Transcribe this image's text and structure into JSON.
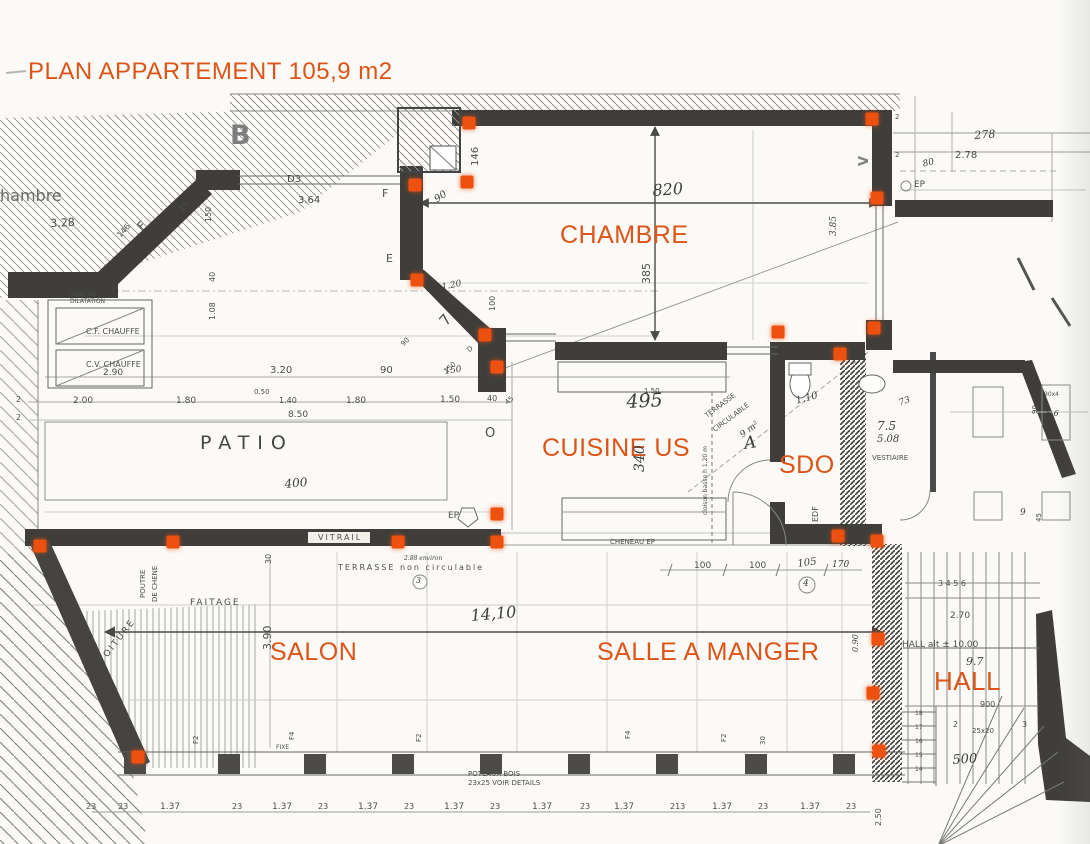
{
  "title": {
    "text": "PLAN APPARTEMENT 105,9 m2"
  },
  "colors": {
    "accent": "#dd5418",
    "marker": "#ee5010",
    "pencil": "#4d4d4d",
    "wall": "#3f3e3b"
  },
  "rooms": [
    {
      "id": "chambre",
      "label": "CHAMBRE",
      "x": 560,
      "y": 221,
      "s": 25
    },
    {
      "id": "cuisine-us",
      "label": "CUISINE US",
      "x": 542,
      "y": 434,
      "s": 25
    },
    {
      "id": "sdo",
      "label": "SDO",
      "x": 779,
      "y": 451,
      "s": 25
    },
    {
      "id": "salon",
      "label": "SALON",
      "x": 270,
      "y": 638,
      "s": 25
    },
    {
      "id": "salle-a-manger",
      "label": "SALLE A MANGER",
      "x": 597,
      "y": 638,
      "s": 25
    },
    {
      "id": "hall",
      "label": "HALL",
      "x": 934,
      "y": 666,
      "s": 26
    }
  ],
  "annotations": [
    {
      "t": "hambre",
      "x": 0,
      "y": 188,
      "s": 16,
      "c": "lt"
    },
    {
      "t": "3.28",
      "x": 50,
      "y": 218,
      "s": 11,
      "r": -3
    },
    {
      "t": "B",
      "x": 230,
      "y": 122,
      "s": 27,
      "c": "bletter"
    },
    {
      "t": "D3",
      "x": 287,
      "y": 175,
      "s": 10
    },
    {
      "t": "3.64",
      "x": 298,
      "y": 196,
      "s": 10
    },
    {
      "t": "F",
      "x": 135,
      "y": 224,
      "s": 12,
      "r": -45
    },
    {
      "t": "25",
      "x": 178,
      "y": 208,
      "s": 8,
      "r": -48
    },
    {
      "t": "146",
      "x": 116,
      "y": 234,
      "s": 8,
      "r": -48
    },
    {
      "t": "150",
      "x": 205,
      "y": 222,
      "s": 8,
      "r": -90
    },
    {
      "t": "F",
      "x": 382,
      "y": 188,
      "s": 11
    },
    {
      "t": "E",
      "x": 386,
      "y": 253,
      "s": 11
    },
    {
      "t": "JOINT DE",
      "x": 70,
      "y": 292,
      "s": 6
    },
    {
      "t": "DILATATION",
      "x": 70,
      "y": 299,
      "s": 6
    },
    {
      "t": "C.F. CHAUFFE",
      "x": 86,
      "y": 328,
      "s": 8
    },
    {
      "t": "C.V. CHAUFFE",
      "x": 86,
      "y": 361,
      "s": 8
    },
    {
      "t": "2.90",
      "x": 103,
      "y": 369,
      "s": 9
    },
    {
      "t": "40",
      "x": 209,
      "y": 282,
      "s": 8,
      "r": -90
    },
    {
      "t": "1.08",
      "x": 209,
      "y": 320,
      "s": 8,
      "r": -90
    },
    {
      "t": "2",
      "x": 16,
      "y": 396,
      "s": 8
    },
    {
      "t": "2",
      "x": 16,
      "y": 414,
      "s": 8
    },
    {
      "t": "3.20",
      "x": 270,
      "y": 366,
      "s": 10
    },
    {
      "t": "90",
      "x": 380,
      "y": 366,
      "s": 10
    },
    {
      "t": "150",
      "x": 444,
      "y": 368,
      "s": 9,
      "r": -8,
      "c": "hand"
    },
    {
      "t": "2.00",
      "x": 73,
      "y": 397,
      "s": 9
    },
    {
      "t": "1.80",
      "x": 176,
      "y": 397,
      "s": 9
    },
    {
      "t": "0.50",
      "x": 254,
      "y": 389,
      "s": 7
    },
    {
      "t": "1.40",
      "x": 279,
      "y": 397,
      "s": 8
    },
    {
      "t": "1.80",
      "x": 346,
      "y": 397,
      "s": 9
    },
    {
      "t": "1.50",
      "x": 440,
      "y": 396,
      "s": 9
    },
    {
      "t": "40",
      "x": 487,
      "y": 395,
      "s": 8
    },
    {
      "t": "45",
      "x": 504,
      "y": 401,
      "s": 7,
      "r": -40
    },
    {
      "t": "8.50",
      "x": 288,
      "y": 411,
      "s": 9
    },
    {
      "t": "PATIO",
      "x": 200,
      "y": 434,
      "s": 19,
      "c": "patio"
    },
    {
      "t": "400",
      "x": 284,
      "y": 478,
      "s": 12,
      "r": -5,
      "c": "hand"
    },
    {
      "t": "VITRAIL",
      "x": 318,
      "y": 534,
      "s": 8,
      "c": "ls2"
    },
    {
      "t": "EP",
      "x": 448,
      "y": 512,
      "s": 9
    },
    {
      "t": "O",
      "x": 485,
      "y": 427,
      "s": 13
    },
    {
      "t": "TERRASSE  non circulable",
      "x": 338,
      "y": 564,
      "s": 8,
      "c": "ls2"
    },
    {
      "t": "2.88 environ",
      "x": 404,
      "y": 556,
      "s": 6,
      "c": "hand"
    },
    {
      "t": "3",
      "x": 416,
      "y": 577,
      "s": 8,
      "c": "hand"
    },
    {
      "t": "820",
      "x": 652,
      "y": 183,
      "s": 16,
      "r": -4,
      "c": "hand"
    },
    {
      "t": "385",
      "x": 641,
      "y": 284,
      "s": 11,
      "r": -90
    },
    {
      "t": "3.85",
      "x": 830,
      "y": 236,
      "s": 9,
      "r": -90,
      "c": "hand"
    },
    {
      "t": "146",
      "x": 471,
      "y": 166,
      "s": 10,
      "r": -90
    },
    {
      "t": "90",
      "x": 433,
      "y": 197,
      "s": 10,
      "r": -35,
      "c": "hand"
    },
    {
      "t": "1.20",
      "x": 441,
      "y": 284,
      "s": 9,
      "r": -12,
      "c": "hand"
    },
    {
      "t": "100",
      "x": 489,
      "y": 311,
      "s": 8,
      "r": -90
    },
    {
      "t": "7",
      "x": 437,
      "y": 319,
      "s": 15,
      "r": -50
    },
    {
      "t": "90",
      "x": 400,
      "y": 343,
      "s": 7,
      "r": -45
    },
    {
      "t": "150",
      "x": 443,
      "y": 370,
      "s": 7,
      "r": -42
    },
    {
      "t": "D",
      "x": 466,
      "y": 349,
      "s": 7,
      "r": -45
    },
    {
      "t": "2",
      "x": 895,
      "y": 114,
      "s": 7
    },
    {
      "t": "2",
      "x": 895,
      "y": 152,
      "s": 7
    },
    {
      "t": "80",
      "x": 922,
      "y": 161,
      "s": 9,
      "r": -15,
      "c": "hand"
    },
    {
      "t": "278",
      "x": 974,
      "y": 130,
      "s": 11,
      "r": -4,
      "c": "hand"
    },
    {
      "t": "2.78",
      "x": 955,
      "y": 151,
      "s": 10
    },
    {
      "t": "EP",
      "x": 914,
      "y": 181,
      "s": 9
    },
    {
      "t": "V",
      "x": 858,
      "y": 166,
      "s": 13,
      "r": -90,
      "c": "bletter"
    },
    {
      "t": "1.50",
      "x": 644,
      "y": 388,
      "s": 7
    },
    {
      "t": "495",
      "x": 626,
      "y": 393,
      "s": 19,
      "r": -3,
      "c": "hand"
    },
    {
      "t": "340",
      "x": 633,
      "y": 472,
      "s": 14,
      "r": -90,
      "c": "hand"
    },
    {
      "t": "TERRASSE",
      "x": 704,
      "y": 414,
      "s": 7,
      "r": -37
    },
    {
      "t": "CIRCULABLE",
      "x": 712,
      "y": 428,
      "s": 7,
      "r": -37
    },
    {
      "t": "9 m²",
      "x": 739,
      "y": 433,
      "s": 9,
      "r": -37,
      "c": "hand"
    },
    {
      "t": "A",
      "x": 743,
      "y": 436,
      "s": 17,
      "r": -8,
      "c": "hand"
    },
    {
      "t": "cloison basse h 1,20 m",
      "x": 703,
      "y": 515,
      "s": 6,
      "r": -90
    },
    {
      "t": "1.10",
      "x": 795,
      "y": 397,
      "s": 10,
      "r": -15,
      "c": "hand"
    },
    {
      "t": "EDF",
      "x": 812,
      "y": 522,
      "s": 8,
      "r": -90
    },
    {
      "t": "73",
      "x": 898,
      "y": 400,
      "s": 9,
      "r": -20,
      "c": "hand"
    },
    {
      "t": "7.5",
      "x": 877,
      "y": 420,
      "s": 12,
      "c": "hand"
    },
    {
      "t": "5.08",
      "x": 877,
      "y": 435,
      "s": 10,
      "c": "hand"
    },
    {
      "t": "VESTIAIRE",
      "x": 872,
      "y": 455,
      "s": 7
    },
    {
      "t": "90x4",
      "x": 1044,
      "y": 392,
      "s": 6
    },
    {
      "t": "5.6",
      "x": 1046,
      "y": 410,
      "s": 8,
      "c": "hand"
    },
    {
      "t": "90",
      "x": 1032,
      "y": 414,
      "s": 7,
      "r": -90
    },
    {
      "t": "45",
      "x": 1036,
      "y": 522,
      "s": 7,
      "r": -90
    },
    {
      "t": "9",
      "x": 1020,
      "y": 509,
      "s": 9,
      "c": "hand"
    },
    {
      "t": "CHENEAU EP",
      "x": 610,
      "y": 539,
      "s": 7
    },
    {
      "t": "100",
      "x": 694,
      "y": 562,
      "s": 9
    },
    {
      "t": "100",
      "x": 749,
      "y": 562,
      "s": 9
    },
    {
      "t": "105",
      "x": 797,
      "y": 560,
      "s": 10,
      "r": -8,
      "c": "hand"
    },
    {
      "t": "170",
      "x": 832,
      "y": 561,
      "s": 9,
      "c": "hand"
    },
    {
      "t": "4",
      "x": 803,
      "y": 580,
      "s": 9,
      "c": "hand"
    },
    {
      "t": "0.90",
      "x": 852,
      "y": 652,
      "s": 8,
      "r": -90,
      "c": "hand"
    },
    {
      "t": "14,10",
      "x": 470,
      "y": 608,
      "s": 16,
      "r": -5,
      "c": "hand"
    },
    {
      "t": "3.90",
      "x": 262,
      "y": 650,
      "s": 11,
      "r": -90
    },
    {
      "t": "30",
      "x": 265,
      "y": 564,
      "s": 8,
      "r": -90
    },
    {
      "t": "FAITAGE",
      "x": 190,
      "y": 599,
      "s": 9,
      "c": "ls2"
    },
    {
      "t": "TOITURE",
      "x": 98,
      "y": 660,
      "s": 9,
      "r": -52,
      "c": "ls2"
    },
    {
      "t": "POUTRE",
      "x": 140,
      "y": 598,
      "s": 7,
      "r": -90
    },
    {
      "t": "DE CHENE",
      "x": 152,
      "y": 602,
      "s": 7,
      "r": -90
    },
    {
      "t": "HALL alt ±  10.00",
      "x": 902,
      "y": 641,
      "s": 9
    },
    {
      "t": "9.7",
      "x": 966,
      "y": 656,
      "s": 11,
      "c": "hand"
    },
    {
      "t": "2.70",
      "x": 950,
      "y": 612,
      "s": 9
    },
    {
      "t": "3  4  5  6",
      "x": 938,
      "y": 580,
      "s": 8
    },
    {
      "t": "900",
      "x": 980,
      "y": 701,
      "s": 8
    },
    {
      "t": "2",
      "x": 953,
      "y": 721,
      "s": 8
    },
    {
      "t": "3",
      "x": 1022,
      "y": 721,
      "s": 8
    },
    {
      "t": "25x20",
      "x": 972,
      "y": 728,
      "s": 7
    },
    {
      "t": "500",
      "x": 952,
      "y": 754,
      "s": 13,
      "r": -4,
      "c": "hand"
    },
    {
      "t": "18",
      "x": 915,
      "y": 711,
      "s": 6
    },
    {
      "t": "17",
      "x": 915,
      "y": 725,
      "s": 6
    },
    {
      "t": "16",
      "x": 915,
      "y": 739,
      "s": 6
    },
    {
      "t": "15",
      "x": 915,
      "y": 753,
      "s": 6
    },
    {
      "t": "14",
      "x": 915,
      "y": 767,
      "s": 6
    },
    {
      "t": "2.50",
      "x": 875,
      "y": 826,
      "s": 8,
      "r": -90
    },
    {
      "t": "F2",
      "x": 193,
      "y": 744,
      "s": 7,
      "r": -90
    },
    {
      "t": "F4",
      "x": 289,
      "y": 740,
      "s": 7,
      "r": -90
    },
    {
      "t": "FIXE",
      "x": 276,
      "y": 745,
      "s": 6
    },
    {
      "t": "F2",
      "x": 416,
      "y": 742,
      "s": 7,
      "r": -90
    },
    {
      "t": "F4",
      "x": 625,
      "y": 739,
      "s": 7,
      "r": -90
    },
    {
      "t": "F2",
      "x": 721,
      "y": 742,
      "s": 7,
      "r": -90
    },
    {
      "t": "30",
      "x": 760,
      "y": 745,
      "s": 7,
      "r": -90
    },
    {
      "t": "POTEAUX BOIS",
      "x": 468,
      "y": 771,
      "s": 7
    },
    {
      "t": "23x25  VOIR DETAILS",
      "x": 468,
      "y": 780,
      "s": 7
    },
    {
      "t": "23",
      "x": 86,
      "y": 803,
      "s": 8
    },
    {
      "t": "23",
      "x": 118,
      "y": 803,
      "s": 8
    },
    {
      "t": "1.37",
      "x": 160,
      "y": 803,
      "s": 9
    },
    {
      "t": "23",
      "x": 232,
      "y": 803,
      "s": 8
    },
    {
      "t": "1.37",
      "x": 272,
      "y": 803,
      "s": 9
    },
    {
      "t": "23",
      "x": 318,
      "y": 803,
      "s": 8
    },
    {
      "t": "1.37",
      "x": 358,
      "y": 803,
      "s": 9
    },
    {
      "t": "23",
      "x": 404,
      "y": 803,
      "s": 8
    },
    {
      "t": "1.37",
      "x": 444,
      "y": 803,
      "s": 9
    },
    {
      "t": "23",
      "x": 490,
      "y": 803,
      "s": 8
    },
    {
      "t": "1.37",
      "x": 532,
      "y": 803,
      "s": 9
    },
    {
      "t": "23",
      "x": 580,
      "y": 803,
      "s": 8
    },
    {
      "t": "1.37",
      "x": 614,
      "y": 803,
      "s": 9
    },
    {
      "t": "213",
      "x": 670,
      "y": 803,
      "s": 8
    },
    {
      "t": "1.37",
      "x": 712,
      "y": 803,
      "s": 9
    },
    {
      "t": "23",
      "x": 758,
      "y": 803,
      "s": 8
    },
    {
      "t": "1.37",
      "x": 800,
      "y": 803,
      "s": 9
    },
    {
      "t": "23",
      "x": 846,
      "y": 803,
      "s": 8
    }
  ],
  "markers": [
    [
      469,
      123
    ],
    [
      872,
      119
    ],
    [
      415,
      185
    ],
    [
      467,
      182
    ],
    [
      877,
      198
    ],
    [
      417,
      280
    ],
    [
      485,
      335
    ],
    [
      497,
      367
    ],
    [
      778,
      332
    ],
    [
      840,
      354
    ],
    [
      874,
      328
    ],
    [
      838,
      536
    ],
    [
      877,
      541
    ],
    [
      878,
      639
    ],
    [
      40,
      546
    ],
    [
      173,
      542
    ],
    [
      398,
      542
    ],
    [
      497,
      514
    ],
    [
      497,
      542
    ],
    [
      138,
      757
    ],
    [
      873,
      693
    ],
    [
      879,
      751
    ]
  ]
}
